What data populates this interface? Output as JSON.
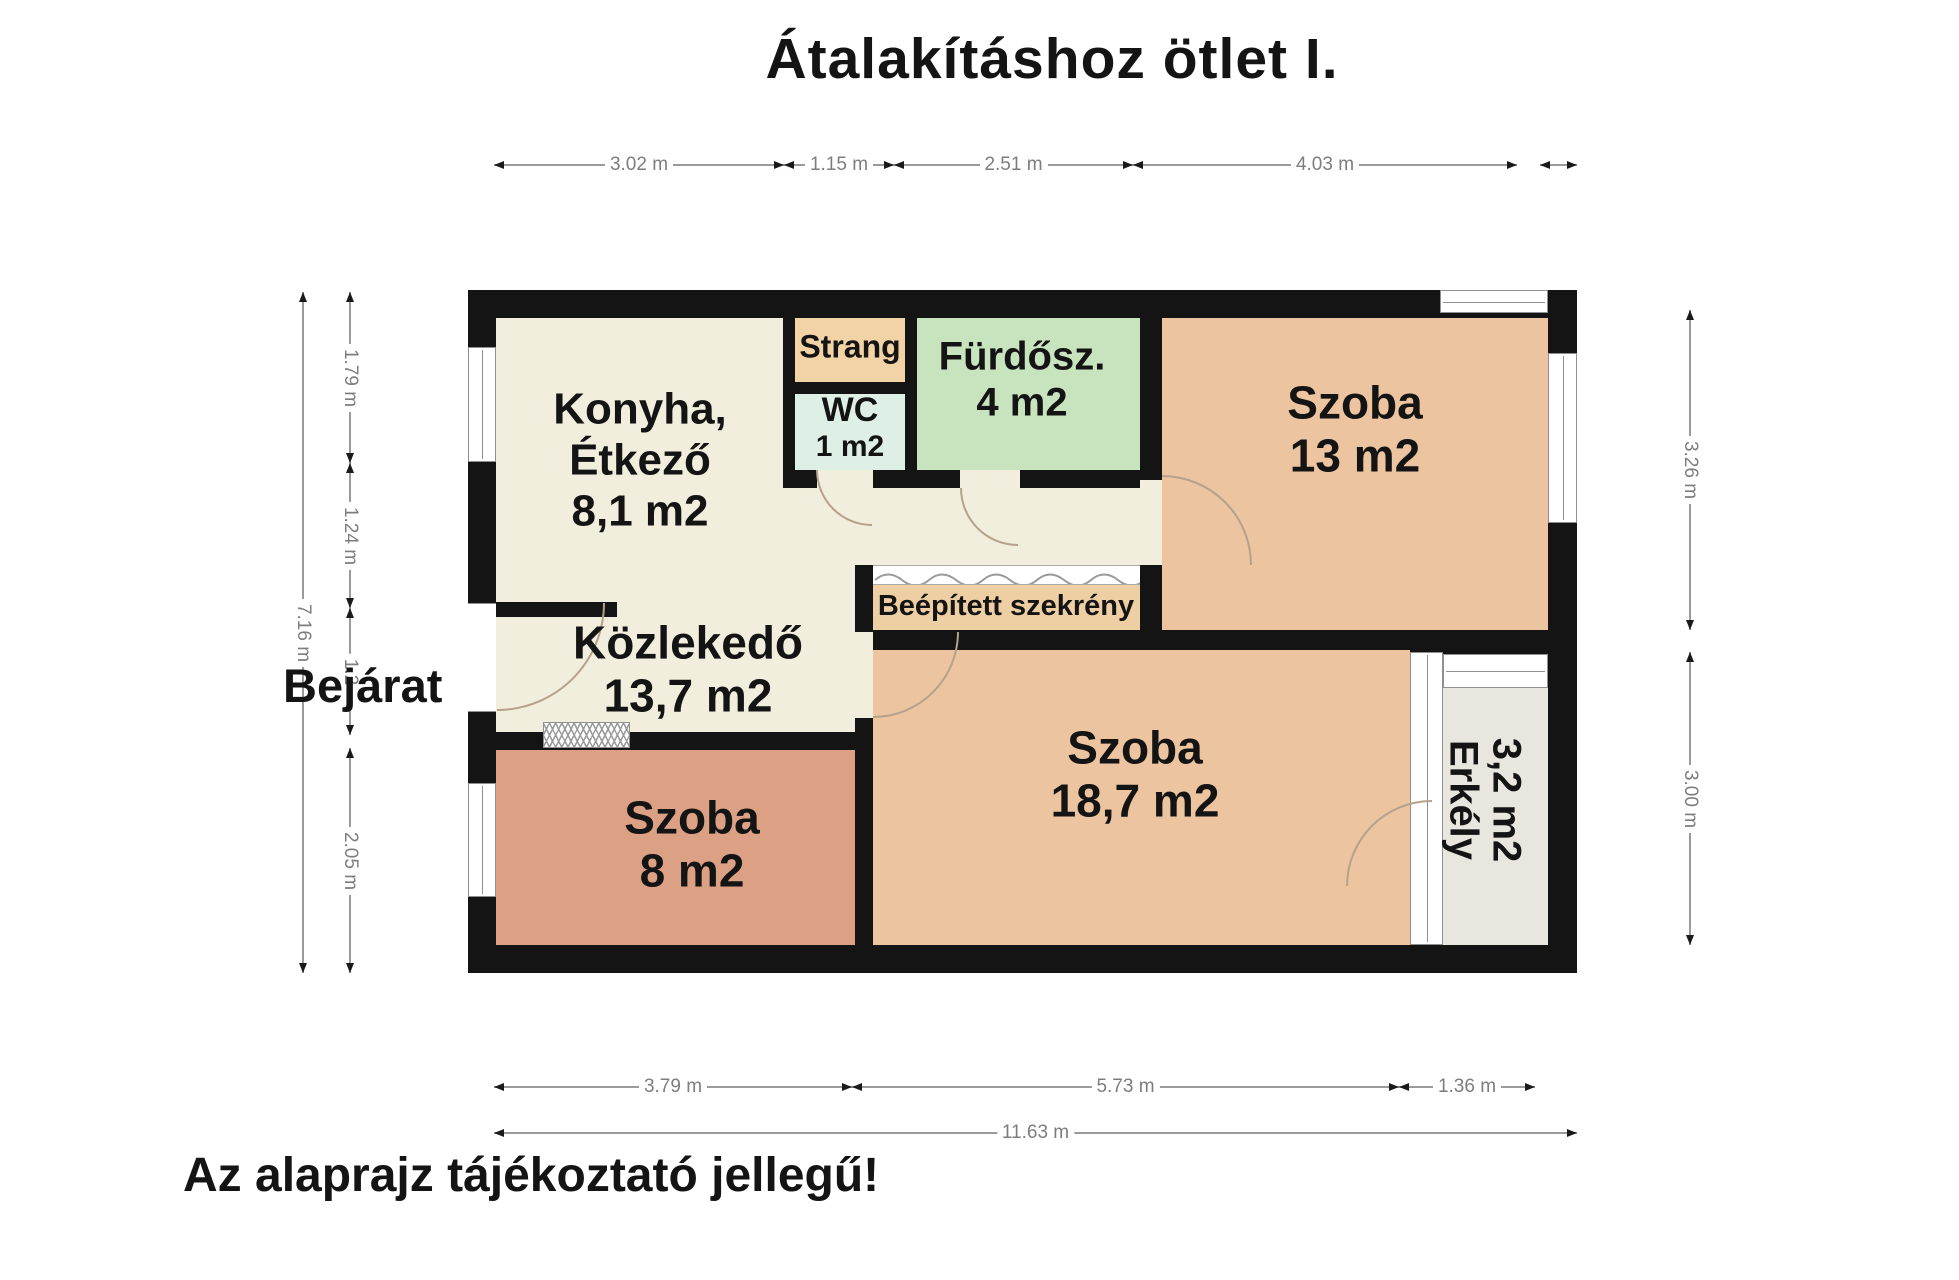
{
  "title": "Átalakításhoz ötlet I.",
  "footer_note": "Az alaprajz tájékoztató jellegű!",
  "entrance_label": "Bejárat",
  "rooms": {
    "kitchen": {
      "line1": "Konyha,",
      "line2": "Étkező",
      "area": "8,1 m2"
    },
    "shaft": {
      "name": "Strang"
    },
    "wc": {
      "name": "WC",
      "area": "1 m2"
    },
    "bathroom": {
      "name": "Fürdősz.",
      "area": "4 m2"
    },
    "room_13": {
      "name": "Szoba",
      "area": "13 m2"
    },
    "hallway": {
      "name": "Közlekedő",
      "area": "13,7 m2"
    },
    "built_in_wardrobe": {
      "name": "Beépített szekrény"
    },
    "room_8": {
      "name": "Szoba",
      "area": "8 m2"
    },
    "room_18_7": {
      "name": "Szoba",
      "area": "18,7 m2"
    },
    "balcony": {
      "name": "Erkély",
      "area": "3,2 m2"
    }
  },
  "dimensions": {
    "top": [
      "3.02 m",
      "1.15 m",
      "2.51 m",
      "4.03 m"
    ],
    "bottom": [
      "3.79 m",
      "5.73 m",
      "1.36 m"
    ],
    "bottom_total": "11.63 m",
    "left": [
      "1.79 m",
      "1.24 m",
      "1.2",
      "2.05 m"
    ],
    "left_total": "7.16 m",
    "right": [
      "3.26 m",
      "3.00 m"
    ]
  },
  "colors": {
    "wall": "#141414",
    "cream": "#f2eedd",
    "shaft": "#f2d3a6",
    "wc": "#def0e6",
    "bathroom": "#c7e4bf",
    "room_tan": "#ecc49f",
    "room_8": "#dca184",
    "wardrobe": "#eecfa4",
    "balcony": "#e9e6df",
    "dim_line": "#9a9a9a",
    "dim_text": "#7d7d7d",
    "arrow": "#1a1a1a",
    "door_arc": "#b5a18c",
    "window_frame": "#8f8f8f"
  }
}
